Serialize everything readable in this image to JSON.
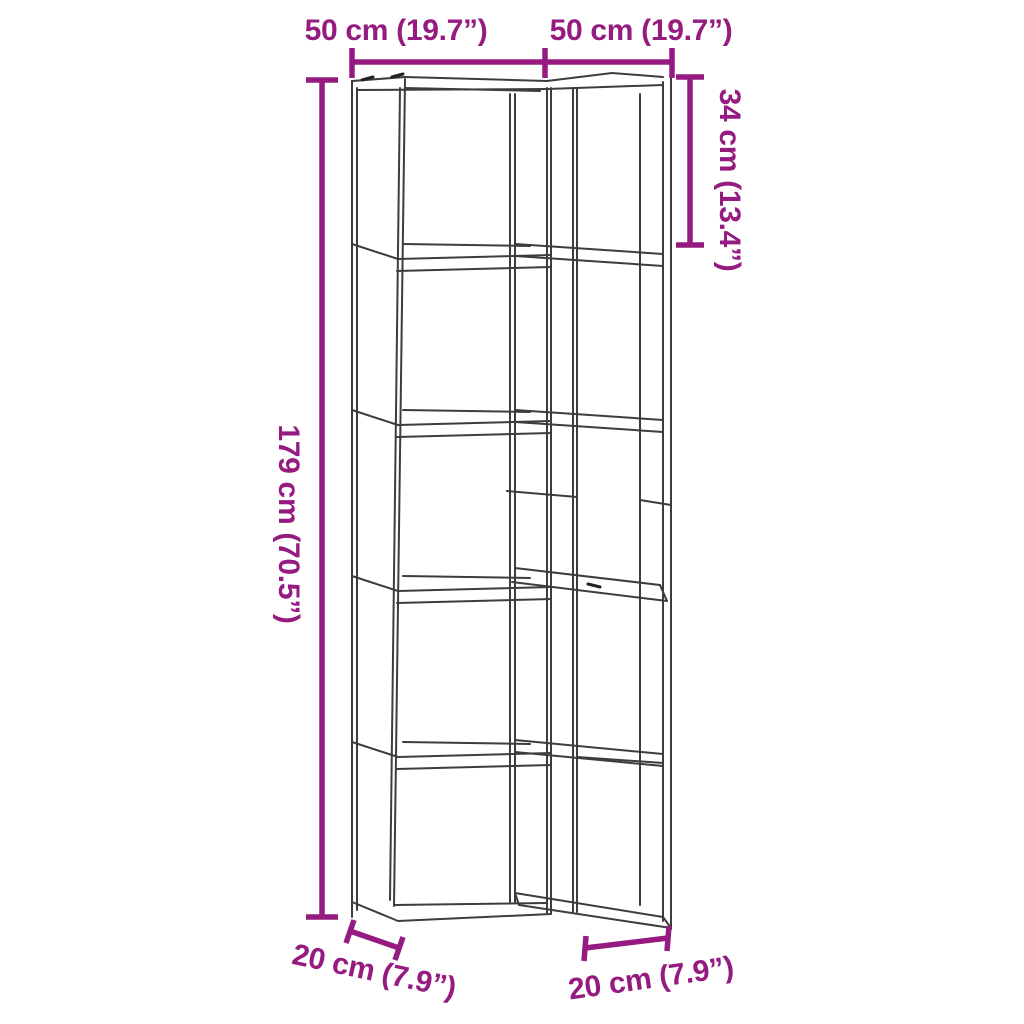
{
  "diagram": {
    "type": "product-dimension-diagram",
    "subject": "5-tier corner bookshelf wireframe drawing",
    "colors": {
      "dimension_accent": "#951B81",
      "outline": "#3D3D3D",
      "background": "#FFFFFF"
    },
    "labels": {
      "top_left_width": "50 cm (19.7”)",
      "top_right_width": "50 cm (19.7”)",
      "top_section_height": "34 cm (13.4”)",
      "total_height": "179 cm (70.5”)",
      "bottom_left_depth": "20 cm (7.9”)",
      "bottom_right_depth": "20 cm (7.9”)"
    }
  }
}
